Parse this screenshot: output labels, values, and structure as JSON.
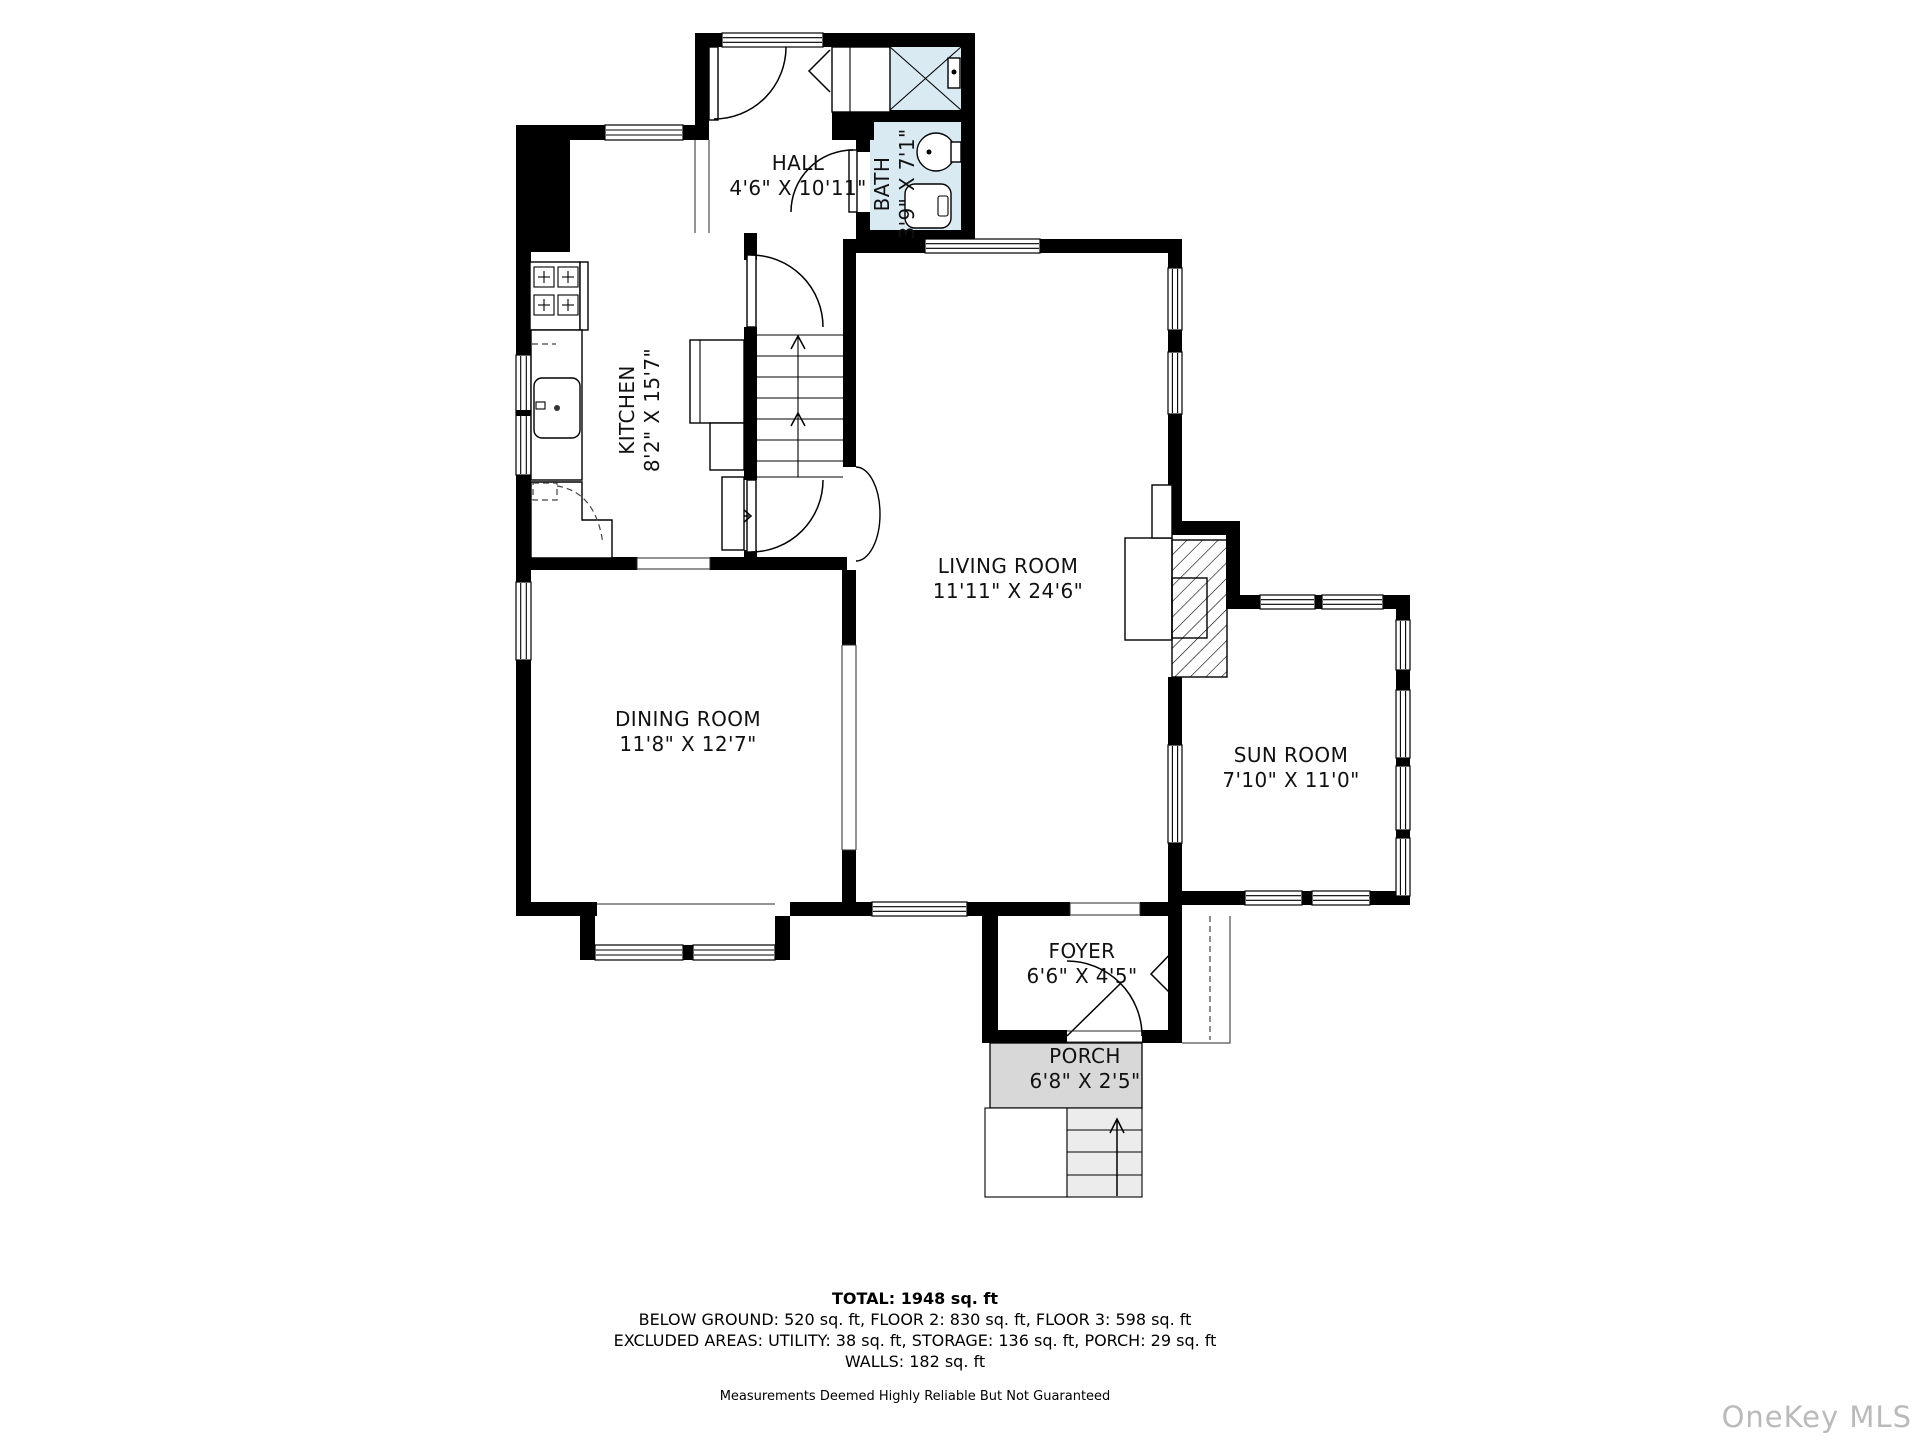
{
  "plan": {
    "rooms": [
      {
        "id": "hall",
        "name": "HALL",
        "dims": "4'6\" X 10'11\""
      },
      {
        "id": "bath",
        "name": "BATH",
        "dims": "3'9\" X 7'1\""
      },
      {
        "id": "kitchen",
        "name": "KITCHEN",
        "dims": "8'2\" X 15'7\""
      },
      {
        "id": "living-room",
        "name": "LIVING ROOM",
        "dims": "11'11\" X 24'6\""
      },
      {
        "id": "dining-room",
        "name": "DINING ROOM",
        "dims": "11'8\" X 12'7\""
      },
      {
        "id": "sun-room",
        "name": "SUN ROOM",
        "dims": "7'10\" X 11'0\""
      },
      {
        "id": "foyer",
        "name": "FOYER",
        "dims": "6'6\" X 4'5\""
      },
      {
        "id": "porch",
        "name": "PORCH",
        "dims": "6'8\" X 2'5\""
      }
    ]
  },
  "summary": {
    "total": "TOTAL: 1948 sq. ft",
    "floors": "BELOW GROUND: 520 sq. ft, FLOOR 2: 830 sq. ft, FLOOR 3: 598 sq. ft",
    "excluded": "EXCLUDED AREAS: UTILITY: 38 sq. ft, STORAGE: 136 sq. ft, PORCH: 29 sq. ft",
    "walls": "WALLS: 182 sq. ft",
    "disclaimer": "Measurements Deemed Highly Reliable But Not Guaranteed"
  },
  "watermark": "OneKey MLS",
  "colors": {
    "wall": "#000000",
    "bath_fill": "#daeaf3",
    "porch_fill": "#d8d8d8",
    "steps_fill": "#ececec",
    "watermark_color": "#bababa"
  }
}
